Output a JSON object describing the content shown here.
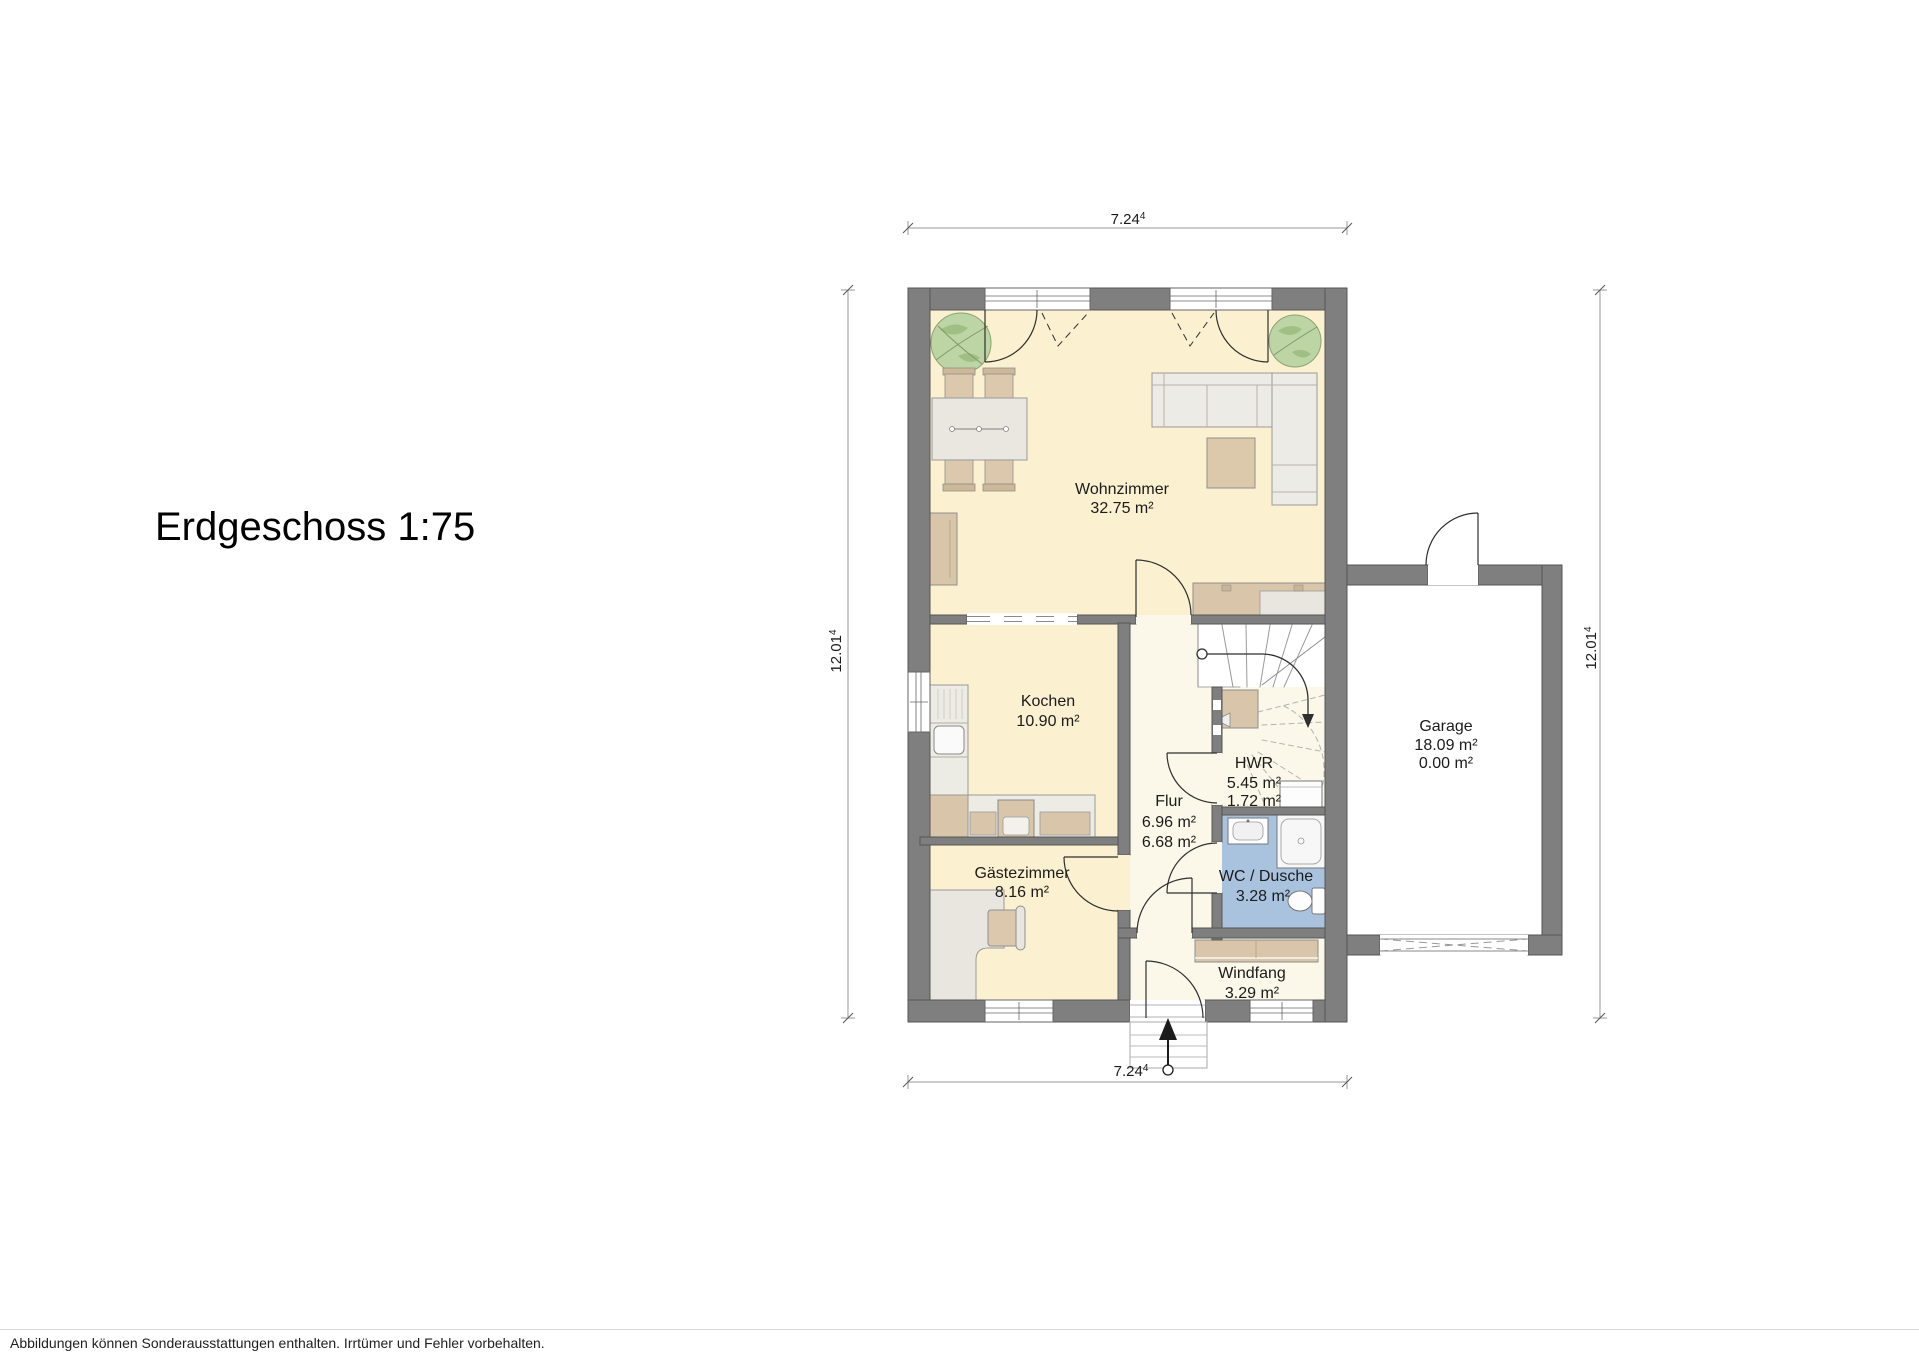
{
  "title": "Erdgeschoss 1:75",
  "footer": {
    "disclaimer": "Abbildungen können Sonderausstattungen enthalten. Irrtümer und Fehler vorbehalten."
  },
  "dimensions": {
    "top": {
      "value": "7.24",
      "sup": "4"
    },
    "bottom": {
      "value": "7.24",
      "sup": "4"
    },
    "left": {
      "value": "12.01",
      "sup": "4"
    },
    "right": {
      "value": "12.01",
      "sup": "4"
    }
  },
  "rooms": {
    "wohnzimmer": {
      "name": "Wohnzimmer",
      "area": "32.75 m²"
    },
    "kochen": {
      "name": "Kochen",
      "area": "10.90 m²"
    },
    "flur": {
      "name": "Flur",
      "area": "6.96 m²",
      "area2": "6.68 m²"
    },
    "hwr": {
      "name": "HWR",
      "area": "5.45 m²",
      "area2": "1.72 m²"
    },
    "wc_dusche": {
      "name": "WC / Dusche",
      "area": "3.28 m²"
    },
    "gaestezimmer": {
      "name": "Gästezimmer",
      "area": "8.16 m²"
    },
    "windfang": {
      "name": "Windfang",
      "area": "3.29 m²"
    },
    "garage": {
      "name": "Garage",
      "area": "18.09 m²",
      "area2": "0.00 m²"
    }
  },
  "colors": {
    "wall": "#7f7f7f",
    "room_cream": "#fbf0cf",
    "room_pale": "#fbf8e9",
    "room_wet_blue": "#a9c3df",
    "furniture_tan": "#d9c6aa",
    "furniture_light": "#eae7e0",
    "plant_green": "#bdd4a4",
    "garage_floor": "#ffffff"
  }
}
